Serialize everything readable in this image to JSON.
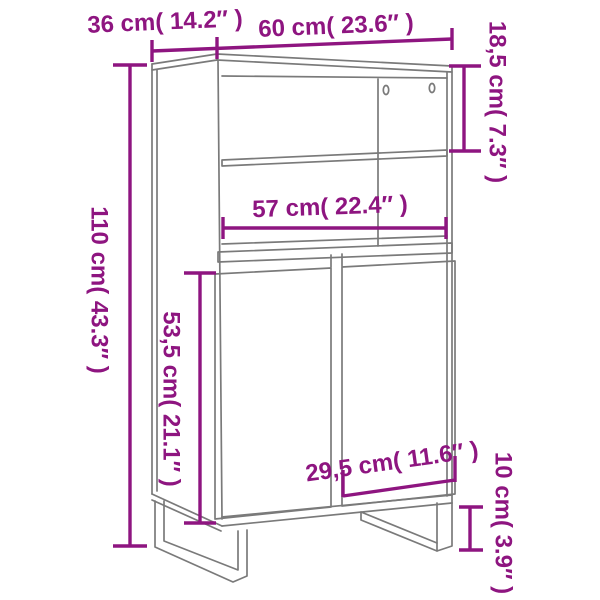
{
  "diagram": {
    "kind": "furniture-dimension-diagram",
    "subject": "highboard cabinet with open shelves, two doors and sled legs",
    "colors": {
      "dimension_accent": "#8E1580",
      "line_art": "#7A7A7A",
      "background": "#FFFFFF"
    },
    "measurements": {
      "depth": {
        "label": "36 cm( 14.2″ )",
        "cm": "36",
        "inch": "14.2"
      },
      "width": {
        "label": "60 cm( 23.6″ )",
        "cm": "60",
        "inch": "23.6"
      },
      "top_section": {
        "label": "18,5 cm( 7.3″ )",
        "cm": "18,5",
        "inch": "7.3"
      },
      "height": {
        "label": "110 cm( 43.3″ )",
        "cm": "110",
        "inch": "43.3"
      },
      "inner_width": {
        "label": "57 cm( 22.4″ )",
        "cm": "57",
        "inch": "22.4"
      },
      "door_height": {
        "label": "53,5 cm( 21.1″ )",
        "cm": "53,5",
        "inch": "21.1"
      },
      "door_width": {
        "label": "29,5 cm( 11.6″ )",
        "cm": "29,5",
        "inch": "11.6"
      },
      "leg_height": {
        "label": "10 cm( 3.9″ )",
        "cm": "10",
        "inch": "3.9"
      }
    }
  }
}
